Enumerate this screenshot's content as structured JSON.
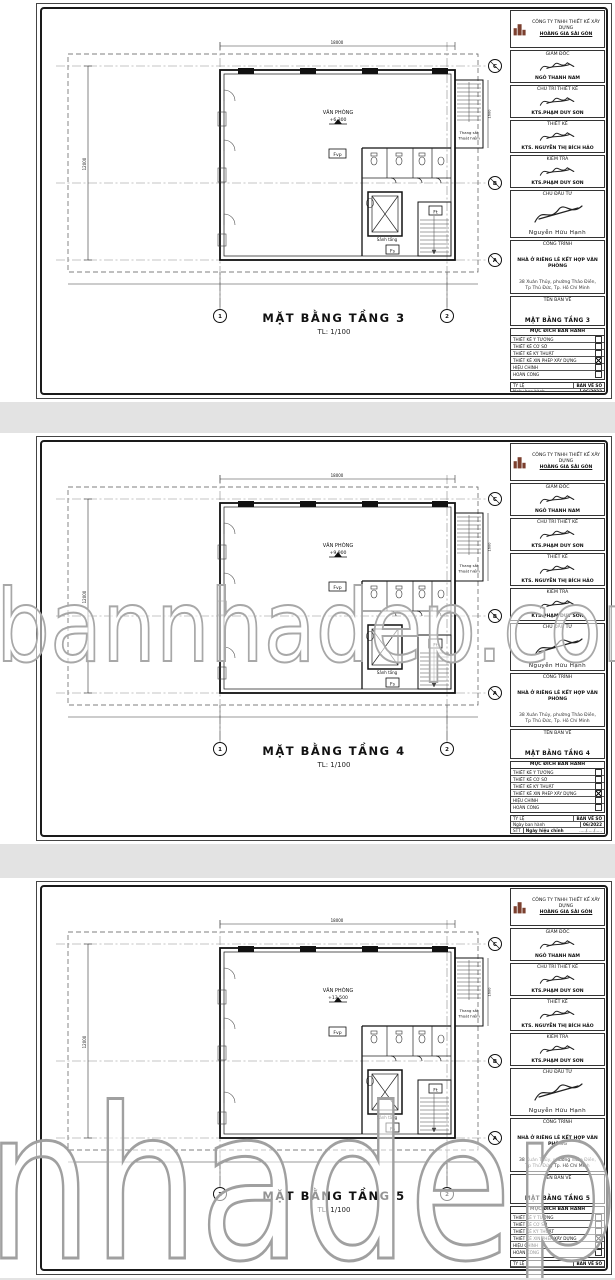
{
  "page": {
    "background": "#e3e3e3",
    "paper": "#ffffff",
    "line_color": "#1a1a1a",
    "logo_color": "#7b3f2e",
    "watermark_outline": "#a8a8a8"
  },
  "watermark": {
    "text": "bannhadep.com"
  },
  "sheets": [
    {
      "title": "MẶT BẰNG TẦNG 3",
      "scale": "TL: 1/100",
      "level": "+6.300",
      "watermark": ""
    },
    {
      "title": "MẶT BẰNG TẦNG 4",
      "scale": "TL: 1/100",
      "level": "+9.900",
      "watermark": "bannhadep.com"
    },
    {
      "title": "MẶT BẰNG TẦNG 5",
      "scale": "TL: 1/100",
      "level": "+13.500",
      "watermark": "bannhadep.com"
    }
  ],
  "titleblock": {
    "company_line1": "CÔNG TY TNHH THIẾT KẾ XÂY DỰNG",
    "company_line2": "HOÀNG GIA SÀI GÒN",
    "roles": [
      {
        "label": "GIÁM ĐỐC",
        "name": "NGÔ THANH NAM"
      },
      {
        "label": "CHỦ TRÌ THIẾT KẾ",
        "name": "KTS.PHẠM DUY SƠN"
      },
      {
        "label": "THIẾT KẾ",
        "name": "KTS. NGUYỄN THỊ BÍCH HẢO"
      },
      {
        "label": "KIỂM TRA",
        "name": "KTS.PHẠM DUY SƠN"
      }
    ],
    "investor_label": "CHỦ ĐẦU TƯ",
    "investor_name": "Nguyễn Hữu Hạnh",
    "project_label": "CÔNG TRÌNH",
    "project_name": "NHÀ Ở RIÊNG LẺ KẾT HỢP VĂN PHÒNG",
    "address_line1": "38 Xuân Thủy, phường Thảo Điền,",
    "address_line2": "Tp Thủ Đức, Tp. Hồ Chí Minh",
    "drawing_label": "TÊN BẢN VẼ",
    "purpose_header": "MỤC ĐÍCH BAN HÀNH",
    "purpose_rows": [
      "THIẾT KẾ Ý TƯỞNG",
      "THIẾT KẾ CƠ SỞ",
      "THIẾT KẾ KỸ THUẬT",
      "THIẾT KẾ XIN PHÉP XÂY DỰNG",
      "HIỆU CHỈNH",
      "HOÀN CÔNG"
    ],
    "footer": {
      "scale_label": "TỶ LỆ",
      "sheetno_label": "BẢN VẼ SỐ",
      "issue_label": "Ngày ban hành",
      "issue_date": "06/2022",
      "stt_label": "STT",
      "revision_label": "Ngày hiệu chỉnh",
      "revision_dots": "...../...../.....",
      "letters": [
        "A",
        "B",
        "C",
        "D"
      ]
    }
  },
  "plan": {
    "labels": {
      "room": "VĂN PHÒNG",
      "fvp": "Fvp",
      "fs": "Fs",
      "ft": "Ft",
      "lobby": "Sảnh tầng",
      "fire_stair_1": "Thang sắt",
      "fire_stair_2": "Thoát hiểm"
    },
    "grid_cols": [
      "1",
      "2"
    ],
    "grid_rows": [
      "C",
      "B",
      "A"
    ],
    "dims": {
      "top": "18000",
      "left": "12000",
      "annex": "1600"
    }
  }
}
